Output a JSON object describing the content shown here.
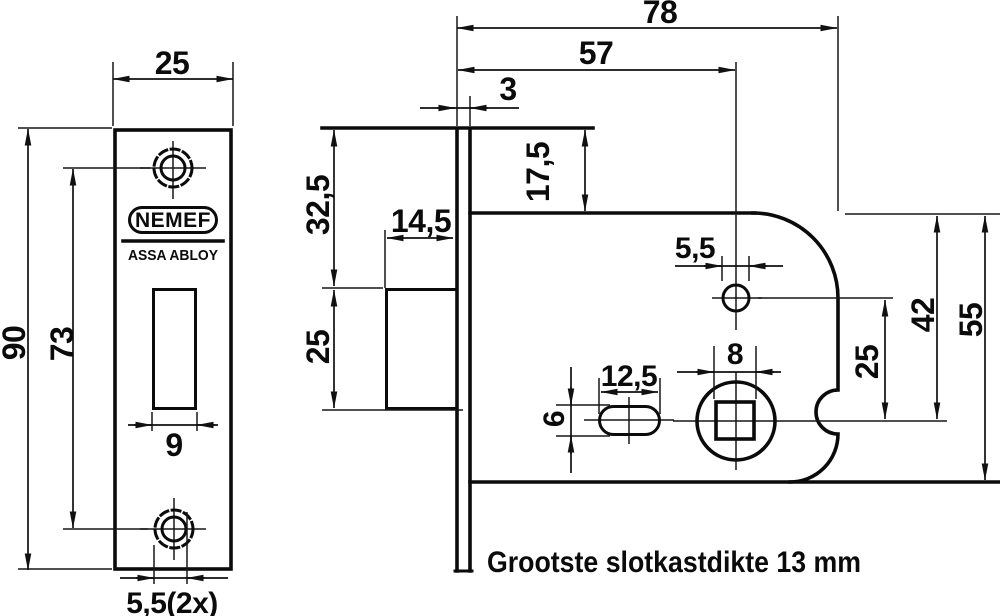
{
  "colors": {
    "ink": "#0b0b0b",
    "background": "#ffffff"
  },
  "drawing": {
    "note": "Grootste slotkastdikte 13 mm",
    "logo": {
      "brand": "NEMEF",
      "group": "ASSA ABLOY"
    },
    "front_view": {
      "plate_width": "25",
      "plate_height": "90",
      "screw_hole_spacing": "73",
      "latch_cutout_width": "9",
      "screw_hole_diameter": "5,5(2x)"
    },
    "side_view": {
      "total_depth": "78",
      "spindle_backset": "57",
      "faceplate_thickness": "3",
      "plate_top_to_case": "17,5",
      "plate_top_to_latch": "32,5",
      "latch_height": "25",
      "latch_depth": "14,5",
      "pin_hole_diameter": "5,5",
      "slot_length": "12,5",
      "slot_height": "6",
      "spindle_square": "8",
      "pin_to_spindle": "25",
      "case_top_to_spindle": "42",
      "case_height": "55"
    }
  }
}
